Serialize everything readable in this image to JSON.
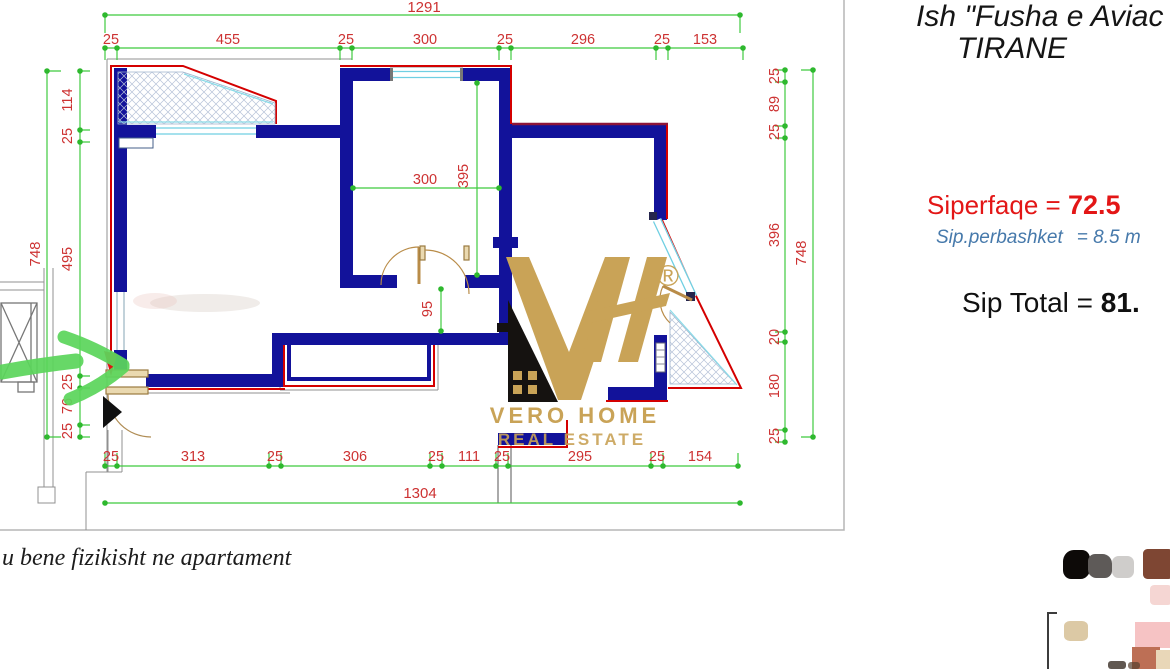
{
  "header": {
    "location_line1": "Ish \"Fusha e Aviac",
    "location_line2": "TIRANE"
  },
  "areas": {
    "surface_label": "Siperfaqe = ",
    "surface_value": "72.5",
    "common_label": "Sip.perbashket",
    "common_value": "= 8.5 m",
    "total_label": "Sip Total = ",
    "total_value": "81."
  },
  "footer_note": "u bene fizikisht ne apartament",
  "logo": {
    "brand": "VERO HOME",
    "tagline": "REAL ESTATE",
    "registered": "®"
  },
  "floor_plan": {
    "dims": {
      "top_total": "1291",
      "top_segments": [
        "25",
        "455",
        "25",
        "300",
        "25",
        "296",
        "25",
        "153"
      ],
      "bottom_total": "1304",
      "bottom_segments": [
        "25",
        "313",
        "25",
        "306",
        "25",
        "111",
        "25",
        "295",
        "25",
        "154"
      ],
      "left_total": "748",
      "left_segments": [
        "114",
        "25",
        "495",
        "25",
        "76",
        "25"
      ],
      "right_total": "748",
      "right_segments": [
        "25",
        "89",
        "25",
        "396",
        "20",
        "180",
        "25"
      ],
      "room_width": "300",
      "room_depth": "395",
      "hallway_width": "95"
    }
  },
  "colors": {
    "wall_navy": "#12129a",
    "outline_red": "#d40000",
    "dim_line_green": "#3fca3f",
    "dim_label_red": "#cd3232",
    "window_cyan": "#6fcfe2",
    "logo_gold": "#c9a357",
    "arrow_green": "#5cd65c",
    "surface_red": "#e31616",
    "common_blue": "#4679ab"
  },
  "thumbnails": {
    "palette": [
      "#0d0a08",
      "#5e5a58",
      "#cfcdcb",
      "#7e4633",
      "#f5d6d3",
      "#f6c3c4",
      "#bd6f55",
      "#dcc9a5",
      "#e9d7b8"
    ]
  }
}
